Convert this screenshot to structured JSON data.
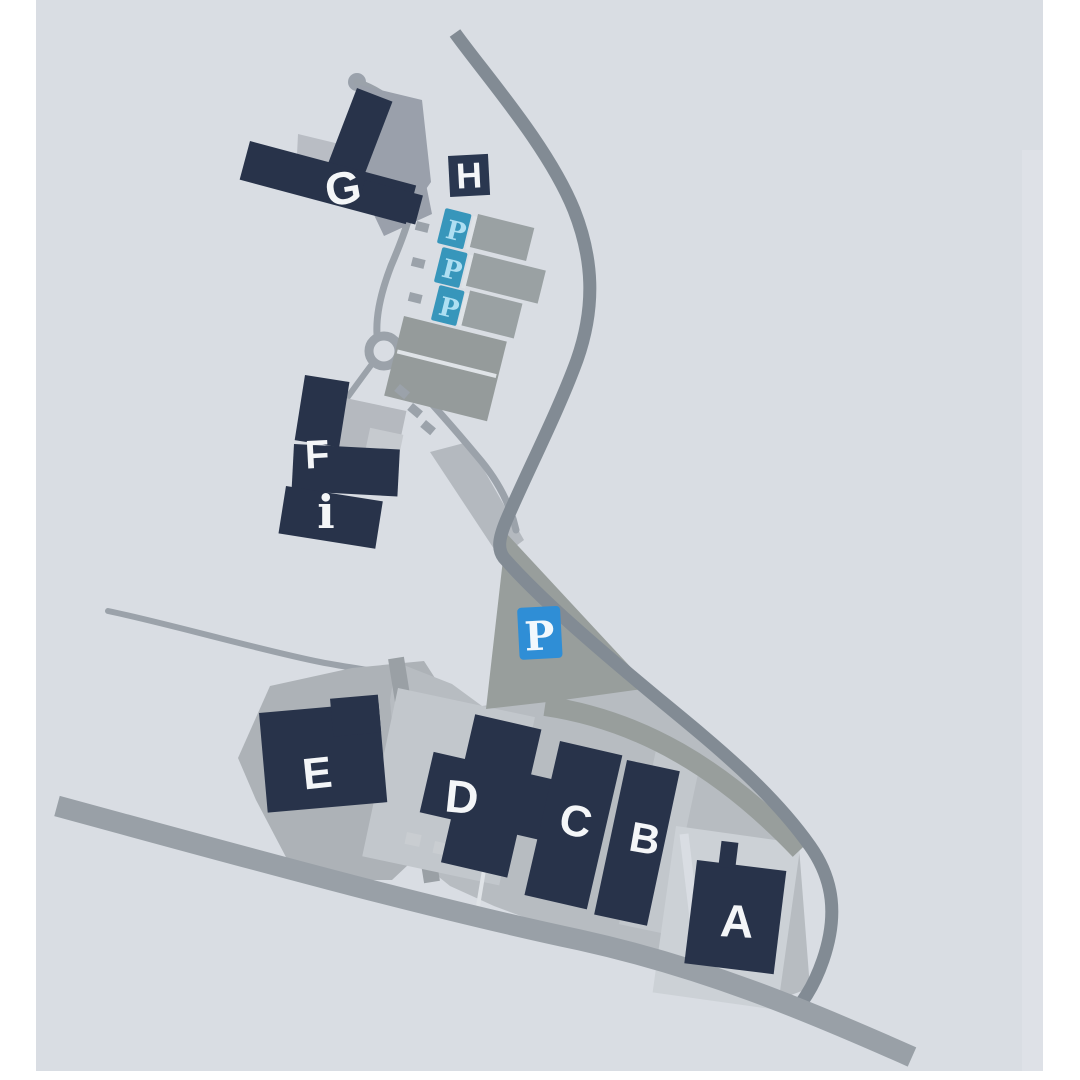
{
  "page": {
    "background": "#ffffff"
  },
  "map": {
    "type": "campus-site-map",
    "background": "#d9dde3",
    "building_labels": {
      "a": "A",
      "b": "B",
      "c": "C",
      "d": "D",
      "e": "E",
      "f": "F",
      "g": "G",
      "h": "H"
    },
    "info_label": "i",
    "parking_label": "P",
    "parking_badge_counts": {
      "large": 1,
      "small": 3
    },
    "colors": {
      "building": "#28334a",
      "road_main": "#828b94",
      "road_light": "#9ba2aa",
      "road_wide": "#99a0a7",
      "plaza": "#b7bcc1",
      "plaza_light": "#c2c7cc",
      "plaza_lighter": "#ccd1d6",
      "lot_gray": "#989e9c",
      "parking_large_badge": "#2f8ed6",
      "parking_small_badge": "#3796bb",
      "parking_small_letter": "#aedff2",
      "label_text": "#f4f6f8",
      "h_badge": "#2a3750"
    }
  }
}
